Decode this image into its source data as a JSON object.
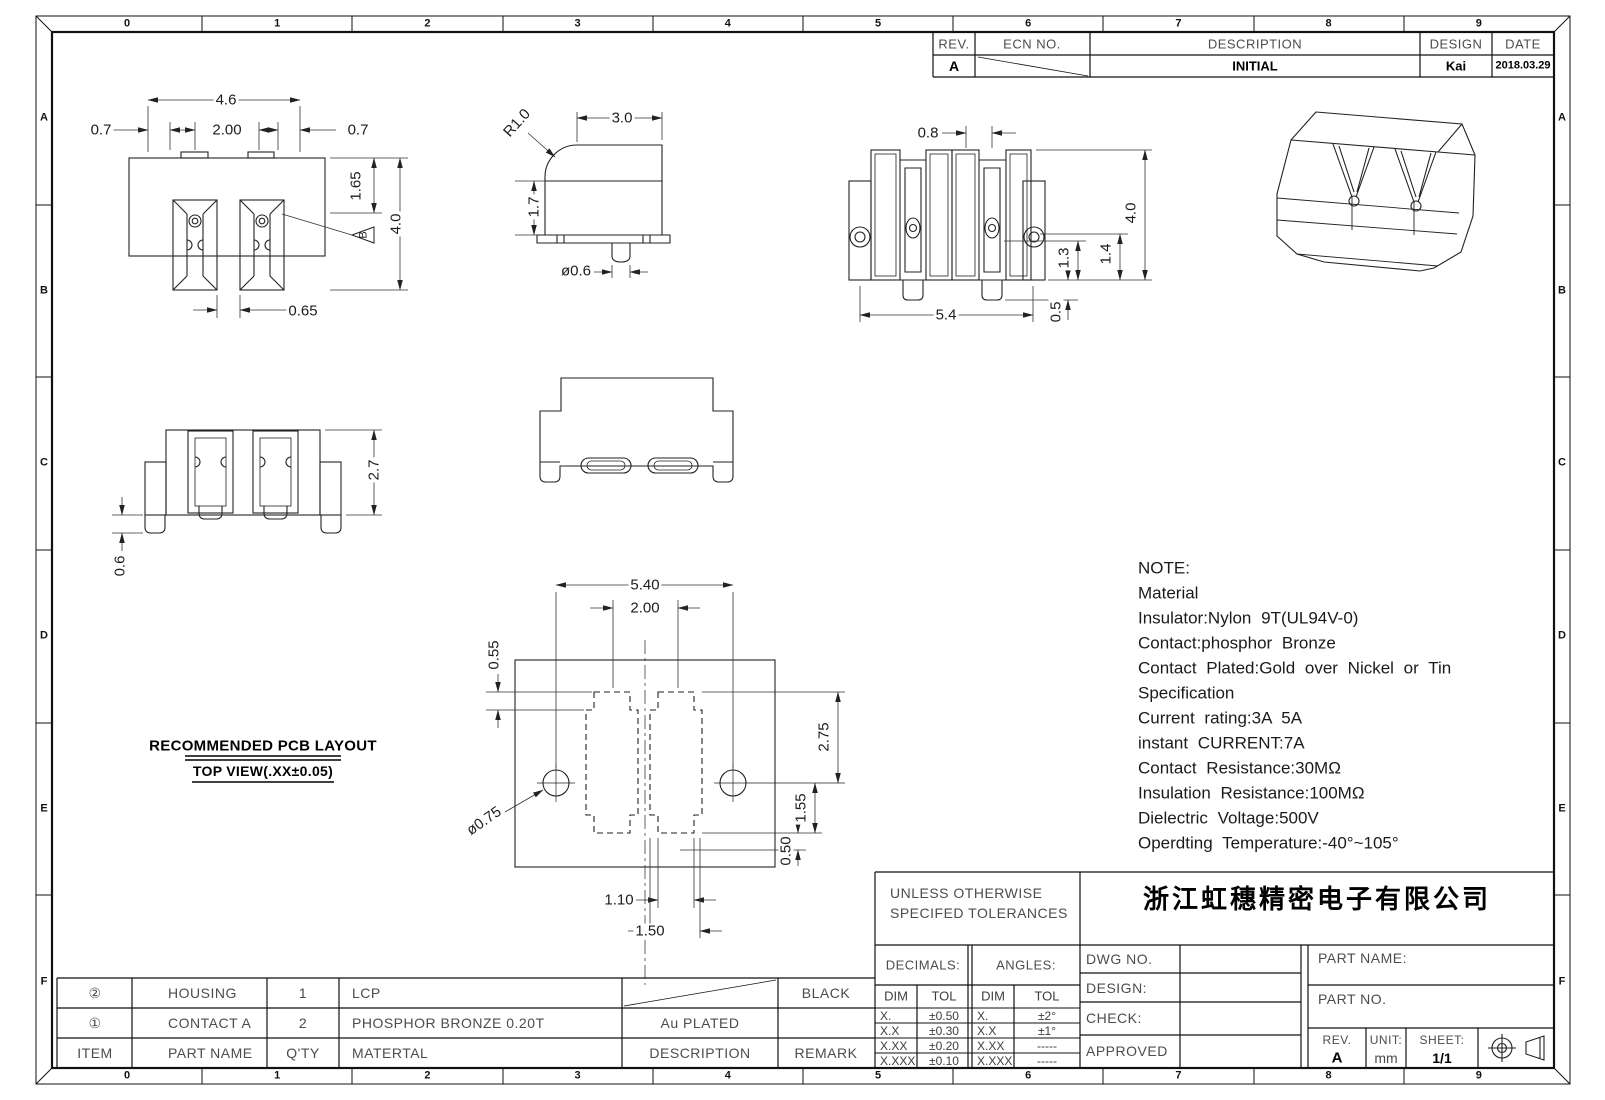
{
  "sheet": {
    "border_columns": [
      "0",
      "1",
      "2",
      "3",
      "4",
      "5",
      "6",
      "7",
      "8",
      "9"
    ],
    "border_rows": [
      "A",
      "B",
      "C",
      "D",
      "E",
      "F"
    ]
  },
  "revision_table": {
    "headers": {
      "rev": "REV.",
      "ecn": "ECN NO.",
      "description": "DESCRIPTION",
      "design": "DESIGN",
      "date": "DATE"
    },
    "entry": {
      "rev": "A",
      "description": "INITIAL",
      "design": "Kai",
      "date": "2018.03.29"
    }
  },
  "notes": {
    "lines": [
      "NOTE:",
      "Material",
      "Insulator:Nylon 9T(UL94V-0)",
      "Contact:phosphor Bronze",
      "Contact Plated:Gold over Nickel or Tin",
      "Specification",
      "Current rating:3A 5A",
      "instant CURRENT:7A",
      "Contact Resistance:30MΩ",
      "Insulation Resistance:100MΩ",
      "Dielectric Voltage:500V",
      "Operdting Temperature:-40°~105°"
    ]
  },
  "views": {
    "front": {
      "overall_width": "4.6",
      "pitch": "2.00",
      "left_offset": "0.7",
      "right_offset": "0.7",
      "step_height": "1.65",
      "overall_height": "4.0",
      "slot_width": "0.65",
      "flag": "B"
    },
    "side": {
      "radius": "R1.0",
      "depth": "3.0",
      "height": "1.7",
      "pin_dia": "ø0.6"
    },
    "back": {
      "slot_width": "0.8",
      "overall_height": "4.0",
      "dim_a": "1.3",
      "dim_b": "1.4",
      "tail": "0.5",
      "width": "5.4"
    },
    "bottom": {
      "height": "2.7",
      "leg": "0.6"
    },
    "pcb": {
      "title": "RECOMMENDED PCB LAYOUT",
      "subtitle": "TOP VIEW(.XX±0.05)",
      "width": "5.40",
      "pitch": "2.00",
      "edge": "0.55",
      "h1": "2.75",
      "h2": "1.55",
      "h3": "0.50",
      "pad_w1": "1.10",
      "pad_w2": "1.50",
      "hole": "ø0.75"
    }
  },
  "bom": {
    "headers": {
      "item": "ITEM",
      "part_name": "PART NAME",
      "qty": "Q'TY",
      "material": "MATERTAL",
      "description": "DESCRIPTION",
      "remark": "REMARK"
    },
    "rows": [
      {
        "item": "②",
        "part_name": "HOUSING",
        "qty": "1",
        "material": "LCP",
        "description": "",
        "remark": "BLACK"
      },
      {
        "item": "①",
        "part_name": "CONTACT A",
        "qty": "2",
        "material": "PHOSPHOR BRONZE 0.20T",
        "description": "Au PLATED",
        "remark": ""
      }
    ]
  },
  "title_block": {
    "tolerance_title_1": "UNLESS OTHERWISE",
    "tolerance_title_2": "SPECIFED TOLERANCES",
    "company": "浙江虹穗精密电子有限公司",
    "decimals_label": "DECIMALS:",
    "angles_label": "ANGLES:",
    "dim": "DIM",
    "tol": "TOL",
    "decimals": [
      [
        "X.",
        "±0.50"
      ],
      [
        "X.X",
        "±0.30"
      ],
      [
        "X.XX",
        "±0.20"
      ],
      [
        "X.XXX",
        "±0.10"
      ]
    ],
    "angles": [
      [
        "X.",
        "±2°"
      ],
      [
        "X.X",
        "±1°"
      ],
      [
        "X.XX",
        "-----"
      ],
      [
        "X.XXX",
        "-----"
      ]
    ],
    "dwg_no": "DWG NO.",
    "design": "DESIGN:",
    "check": "CHECK:",
    "approved": "APPROVED",
    "part_name": "PART NAME:",
    "part_no": "PART NO.",
    "rev_label": "REV.",
    "rev": "A",
    "unit_label": "UNIT:",
    "unit": "mm",
    "sheet_label": "SHEET:",
    "sheet": "1/1"
  }
}
